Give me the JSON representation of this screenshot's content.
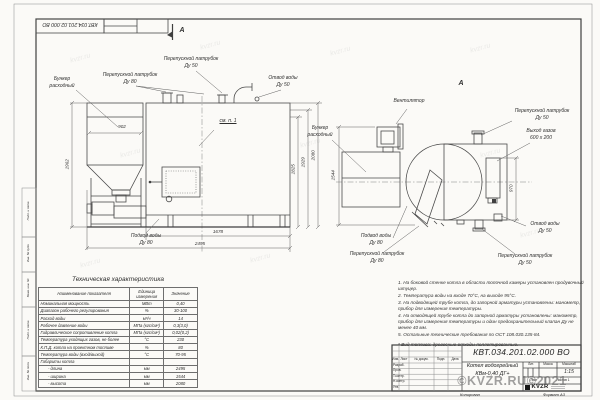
{
  "page": {
    "stamp_top": "КВТ.034.201.02.000 ВО",
    "copied_label": "Копировал",
    "format_label": "Формат А3"
  },
  "watermark": {
    "big": "©KVZR.RU©2021",
    "tile": "kvzr.ru"
  },
  "margin_labels": [
    "Инв. № подл.",
    "Подп. и дата",
    "Взам. инв. №",
    "Инв. № дубл.",
    "Подп. и дата"
  ],
  "views": {
    "front": {
      "section_mark": "А",
      "callouts": {
        "hopper1": "Бункер",
        "hopper2": "расходный",
        "bypass80": "Перепускной патрубок",
        "bypass80_size": "Ду 80",
        "bypass50": "Перепускной патрубок",
        "bypass50_size": "Ду 50",
        "outlet": "Отвод воды",
        "outlet_size": "Ду 50",
        "inlet": "Подвод воды",
        "inlet_size": "Ду 80",
        "see_note": "см. п. 1"
      },
      "dims": {
        "hopper_width": "902",
        "height_left": "1962",
        "h1": "1825",
        "h2": "1929",
        "h3": "2080",
        "body_length": "1678",
        "total_length": "2495"
      }
    },
    "side": {
      "view_mark": "А",
      "callouts": {
        "hopper1": "Бункер",
        "hopper2": "расходный",
        "fan": "Вентилятор",
        "bypass50_top": "Перепускной патрубок",
        "bypass50_top_size": "Ду 50",
        "gas1": "Выход газов",
        "gas2": "600 х 200",
        "outlet": "Отвод воды",
        "outlet_size": "Ду 50",
        "bypass50_bot": "Перепускной патрубок",
        "bypass50_bot_size": "Ду 50",
        "bypass80": "Перепускной патрубок",
        "bypass80_size": "Ду 80",
        "inlet": "Подвод воды",
        "inlet_size": "Ду 80"
      },
      "dims": {
        "width": "1544",
        "gas_offset": "970"
      }
    }
  },
  "spec_table": {
    "title": "Техническая характеристика",
    "headers": [
      "Наименование показателя",
      "Единица измерения",
      "Значение"
    ],
    "rows": [
      [
        "Номинальная мощность",
        "МВт",
        "0,40"
      ],
      [
        "Диапазон рабочего регулирования",
        "%",
        "30-100"
      ],
      [
        "Расход воды",
        "м³/ч",
        "14"
      ],
      [
        "Рабочее давление воды",
        "МПа (кгс/см²)",
        "0,3(3,0)"
      ],
      [
        "Гидравлическое сопротивление котла",
        "МПа (кгс/см²)",
        "0,02(0,2)"
      ],
      [
        "Температура уходящих газов, не более",
        "°С",
        "230"
      ],
      [
        "К.П.Д. котла на проектном топливе",
        "%",
        "80"
      ],
      [
        "Температура воды (вход/выход)",
        "°С",
        "70-95"
      ],
      [
        "Габариты котла",
        "",
        ""
      ],
      [
        "- длина",
        "мм",
        "2495"
      ],
      [
        "- ширина",
        "мм",
        "1544"
      ],
      [
        "- высота",
        "мм",
        "2080"
      ]
    ]
  },
  "notes": {
    "items": [
      "1. На боковой стенке котла в области топочной камеры установлен продувочный штуцер.",
      "2. Температура воды на входе 70°С, на выходе 95°С.",
      "3. На подводящей трубе котла, до запорной арматуры установлены: манометр, прибор для измерения температуры.",
      "4. На отводящей трубе котла до запорной арматуры установлены: манометр, прибор для измерения температуры и один предохранительный клапан Ду не менее 40 мм.",
      "5. Остальные технические требования по ОСТ 108.030.135-84."
    ],
    "fuel": "* Вид топлива: древесные отходы пеллетированные."
  },
  "titleblock": {
    "doc_number": "КВТ.034.201.02.000 ВО",
    "title1": "Котел водогрейный",
    "title2": "КВм-0,40 ДГ+",
    "col_izm": "Изм.",
    "col_list": "Лист",
    "col_doc": "№ докум.",
    "col_podp": "Подп.",
    "col_data": "Дата",
    "row_razrab": "Разраб.",
    "row_prov": "Пров.",
    "row_tkontr": "Т.контр.",
    "row_nkontr": "Н.контр.",
    "row_utv": "Утв.",
    "lit": "Лит.",
    "mass": "Масса",
    "scale_label": "Масштаб",
    "scale": "1:15",
    "sheet": "Лист",
    "sheets": "Листов 1",
    "logo": "KVZR"
  }
}
